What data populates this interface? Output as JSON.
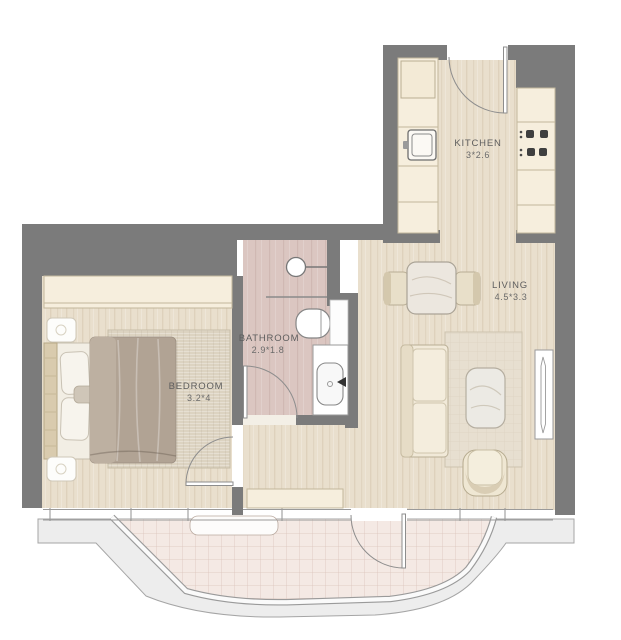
{
  "plan_title": "apartment-floor-plan",
  "rooms": {
    "kitchen": {
      "label": "KITCHEN",
      "dimensions": "3*2.6"
    },
    "living": {
      "label": "LIVING",
      "dimensions": "4.5*3.3"
    },
    "bathroom": {
      "label": "BATHROOM",
      "dimensions": "2.9*1.8"
    },
    "bedroom": {
      "label": "BEDROOM",
      "dimensions": "3.2*4"
    }
  },
  "fixtures": [
    "entry-door",
    "fridge",
    "kitchen-sink",
    "stove",
    "wash-basin",
    "shower-partition",
    "toilet",
    "vanity-basin",
    "wardrobe",
    "bed",
    "nightstand",
    "rug",
    "dining-table",
    "dining-chair",
    "sofa",
    "coffee-table",
    "armchair",
    "window",
    "balcony",
    "railing",
    "hall-cabinet"
  ],
  "colors": {
    "wall": "#7b7b7b",
    "floor_wood": "#e9dfcd",
    "cabinet_cream": "#f6eedd",
    "bathroom_floor": "#dbc6c1",
    "balcony_tile": "#f4e9e4",
    "balcony_slab": "#ededed",
    "rug": "#dcd3c1",
    "duvet": "#b1a394",
    "label_text": "#5e5e5e"
  }
}
